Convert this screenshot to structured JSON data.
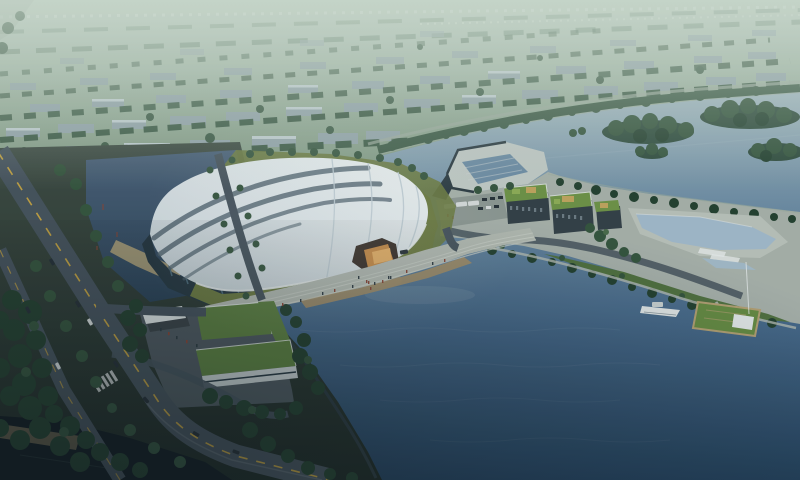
{
  "scene": {
    "description": "Aerial dusk rendering of a large white curved-roof exhibition hall on a lakeside site, with an illuminated amber entrance, lakefront promenade, landscaped peninsula with green-roof buildings and reflecting pool, a small pier with boat, an L-shaped green-roof office building, tree-lined avenues, and hazy city blocks in the distance",
    "time_of_day": "dusk",
    "view": "aerial oblique"
  },
  "palette": {
    "haze-top": "#b8c9bd",
    "field": "#7e9780",
    "city-bld": "#93a4aa",
    "city-bld-light": "#c0cdd1",
    "city-tree": "#3d5a46",
    "far-tree": "#55735f",
    "speck": "#d9e3da",
    "pale-road": "#9cab9e",
    "shore-sand": "#b0a078",
    "water-far": "#a2b7c0",
    "water-mid": "#6d8ca4",
    "water-main": "#46688a",
    "water-deep": "#23405c",
    "water-black": "#10191f",
    "land1": "#3e4b43",
    "land2": "#1d2824",
    "pond1": "#4a6078",
    "pond2": "#2b4156",
    "road": "#46525c",
    "road-line": "#c9a43f",
    "lane-white": "#cdd4d6",
    "parapet": "#6d7880",
    "tree-dark": "#24402f",
    "tree-mid": "#35543d",
    "tree-light": "#4a6b4a",
    "grass-olive": "#6d7b41",
    "lawn": "#51713f",
    "roof-white": "#f0f4f5",
    "roof-shade": "#c6d1d7",
    "rib-dark": "#50626e",
    "seam-light": "#bfccd4",
    "facade": "#273741",
    "glass": "#4d6a7a",
    "plaza": "#b5bbb3",
    "plaza-steps": "#ced3cb",
    "deck": "#a08c68",
    "glow": "#c98a45",
    "glow-bright": "#e8b066",
    "spill": "#d9a55f",
    "concrete": "#c2cac6",
    "embankment": "#2c3a42",
    "pool": "#a3bacc",
    "green-roof": "#6f9347",
    "green-roof-l": "#5d8040",
    "roof-panel": "#8fae57",
    "roof-tan": "#c2a55e",
    "bld-dark": "#333f47",
    "window": "#7d8c93",
    "pen-base": "#a9b2ab",
    "pen-pave": "#bcc3bb",
    "lot": "#8d9792",
    "pier-green": "#678c42",
    "pier-edge": "#b7a274",
    "white": "#e8ecec",
    "boat-top": "#cfd6d6",
    "car-dark": "#262f36",
    "car-light": "#d8dcdc",
    "people-red": "#8a4434",
    "people-dark": "#2e3a42",
    "site-plaza": "#4e585f",
    "l-wall": "#c9d1d2",
    "canopy": "#dfe4e4",
    "refl": "#cfd8da",
    "tint": "#2e4d57",
    "haze-strong": "#d7e4d8"
  }
}
